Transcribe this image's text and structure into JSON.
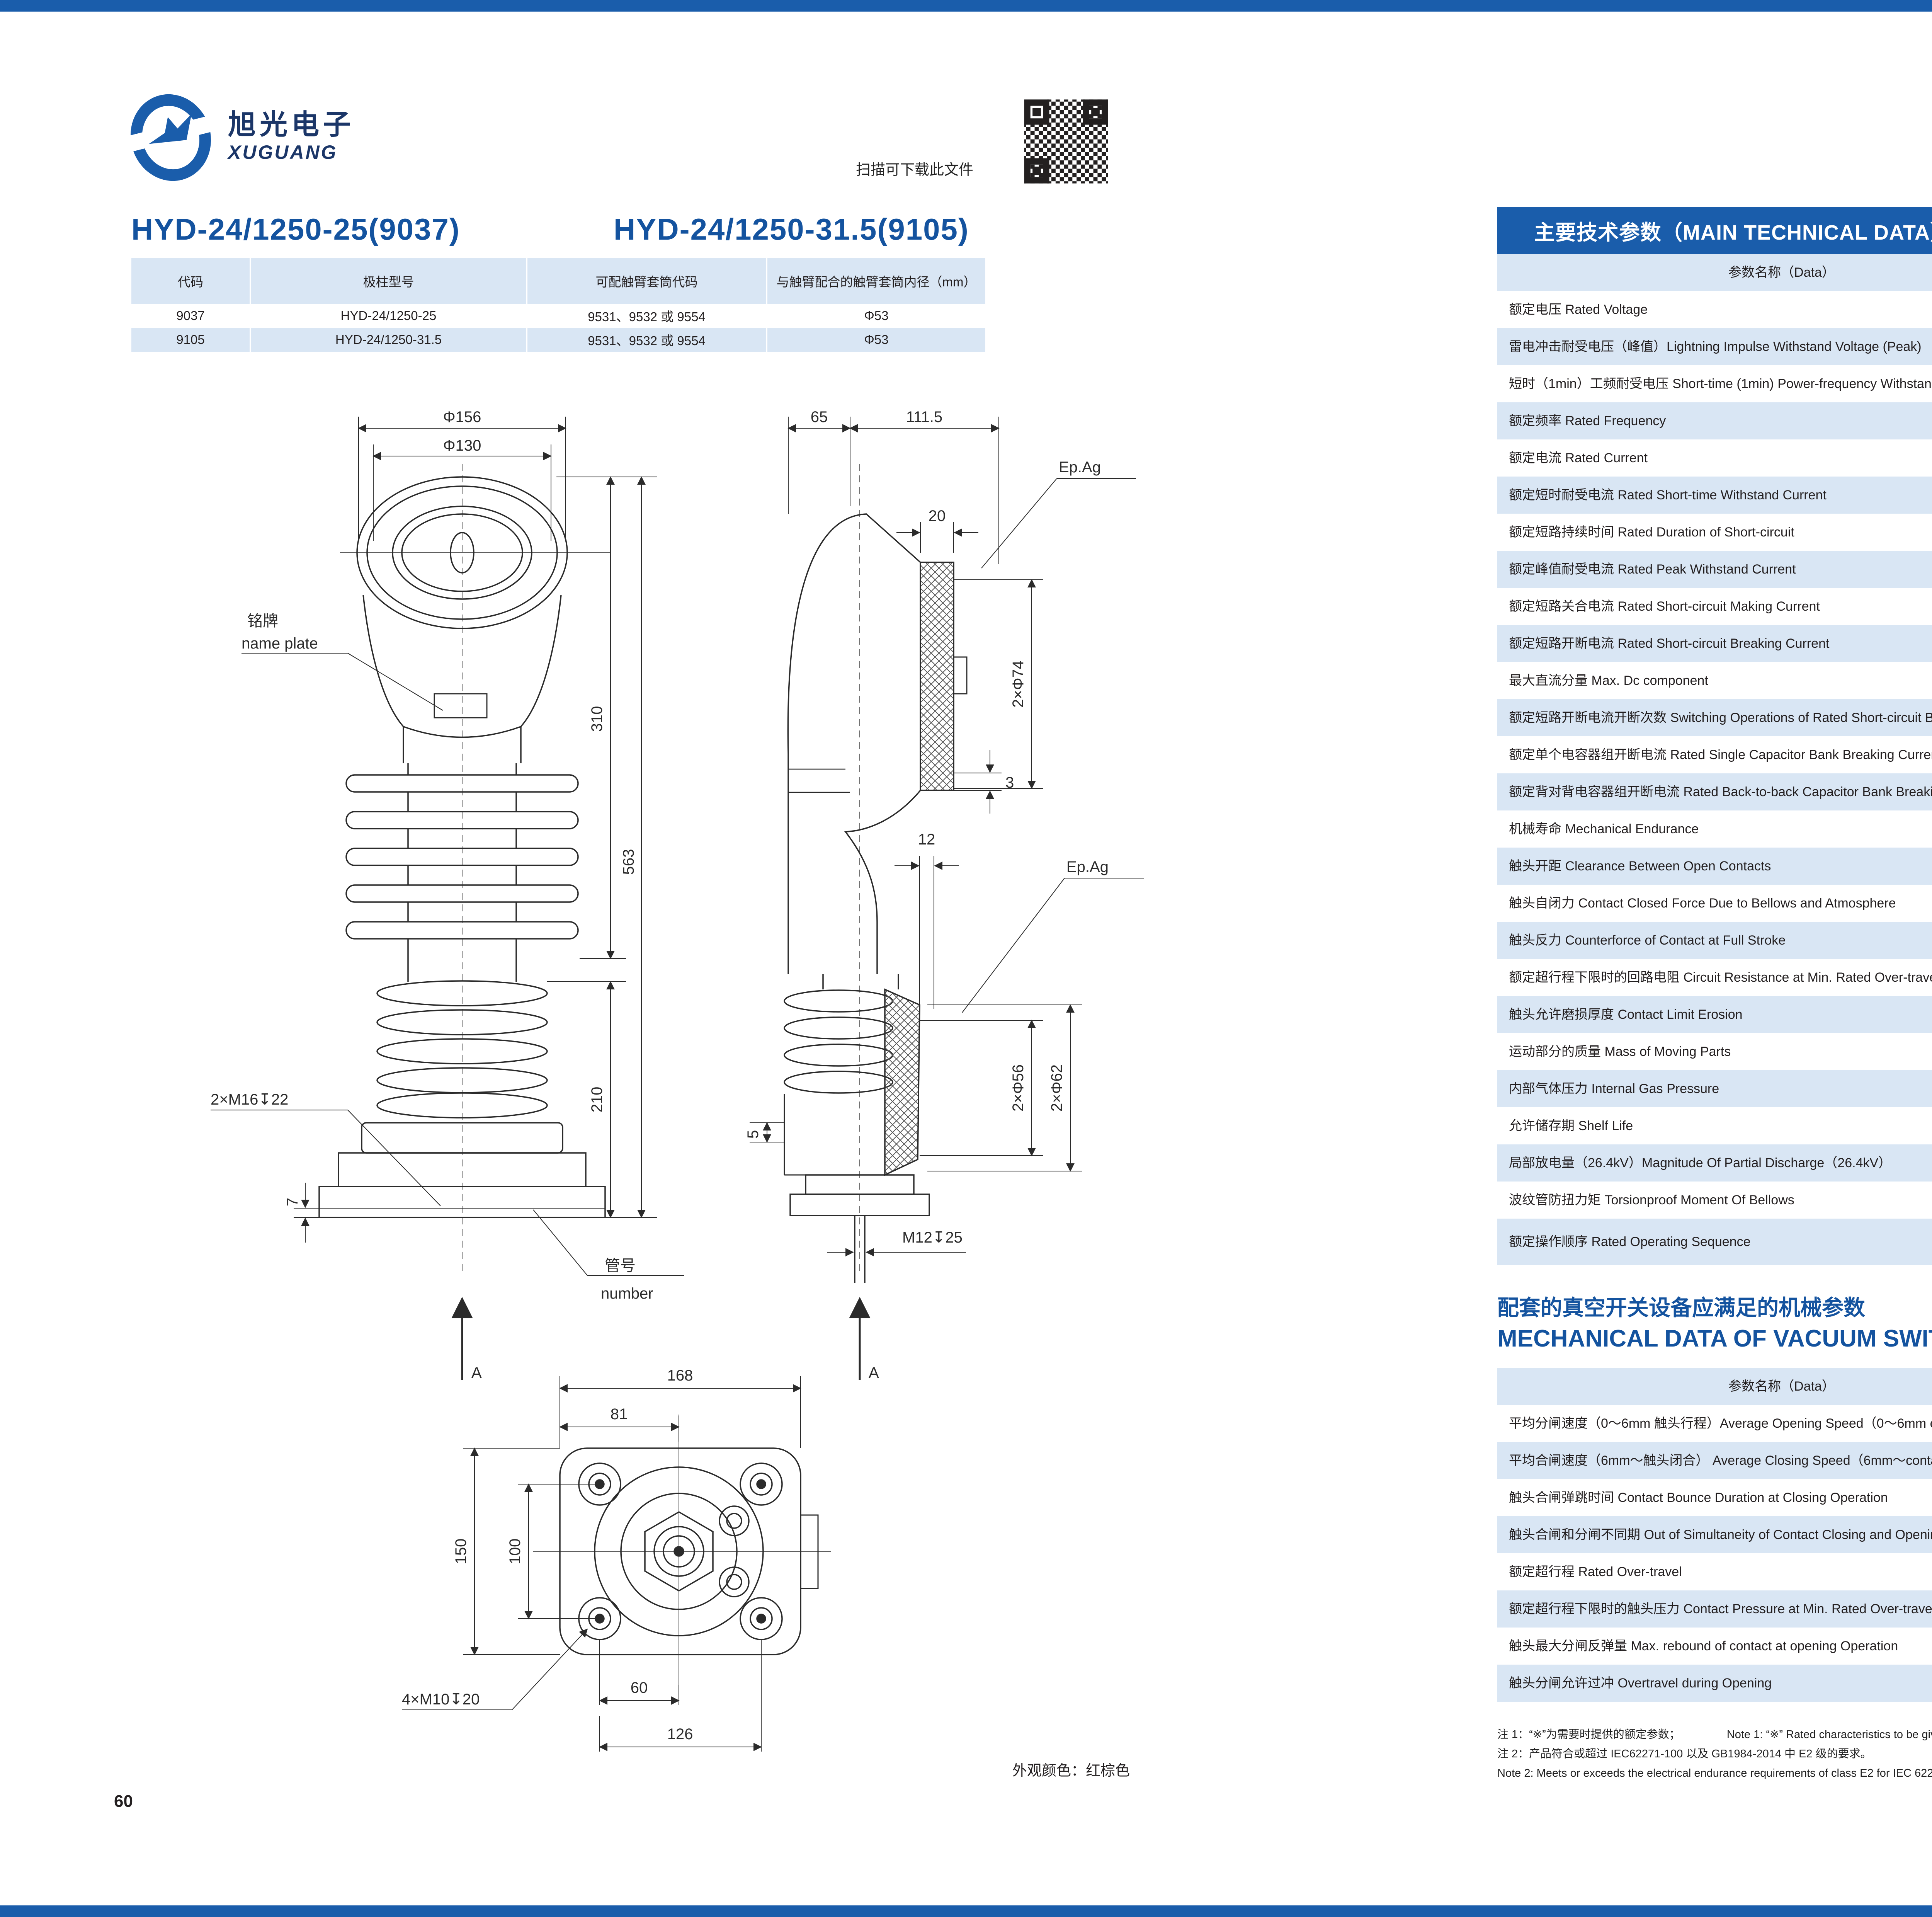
{
  "colors": {
    "accent": "#1a5dab",
    "rowblue": "#d9e6f4",
    "titleblue": "#14539f",
    "ink": "#231f20",
    "navy": "#1b3668"
  },
  "page_left": {
    "logo": {
      "cn": "旭光电子",
      "en": "XUGUANG"
    },
    "qr_caption": "扫描可下载此文件",
    "title_left": "HYD-24/1250-25(9037)",
    "title_right": "HYD-24/1250-31.5(9105)",
    "spec_table": {
      "headers": [
        "代码",
        "极柱型号",
        "可配触臂套筒代码",
        "与触臂配合的触臂套筒内径（mm）"
      ],
      "rows": [
        [
          "9037",
          "HYD-24/1250-25",
          "9531、9532 或 9554",
          "Φ53"
        ],
        [
          "9105",
          "HYD-24/1250-31.5",
          "9531、9532 或 9554",
          "Φ53"
        ]
      ]
    },
    "drawing": {
      "front": {
        "phi156": "Φ156",
        "phi130": "Φ130",
        "nameplate_cn": "铭牌",
        "nameplate_en": "name plate",
        "thread": "2×M16↧22",
        "dim310": "310",
        "dim563": "563",
        "dim210": "210",
        "dim7": "7",
        "tube_cn": "管号",
        "tube_en": "number",
        "view": "A"
      },
      "side": {
        "dim65": "65",
        "dim111": "111.5",
        "dim20": "20",
        "epag_top": "Ep.Ag",
        "phi74": "2×Φ74",
        "dim3": "3",
        "dim12": "12",
        "epag_mid": "Ep.Ag",
        "phi56": "2×Φ56",
        "phi62": "2×Φ62",
        "dim5": "5",
        "thread": "M12↧25",
        "view": "A"
      },
      "bottom": {
        "dim168": "168",
        "dim81": "81",
        "dim150": "150",
        "dim100": "100",
        "dim60": "60",
        "dim126": "126",
        "thread": "4×M10↧20"
      }
    },
    "color_note": "外观颜色：红棕色",
    "page_number": "60"
  },
  "page_right": {
    "logo": {
      "cn": "旭光电子",
      "en": "XUGUANG"
    },
    "banner": "主要技术参数（MAIN TECHNICAL DATA）",
    "main_table": {
      "headers": [
        "参数名称（Data）",
        "单位 (Unit)",
        "数值（Value）"
      ],
      "rows": [
        {
          "label": "额定电压 Rated Voltage",
          "unit": "kV",
          "value": "24"
        },
        {
          "label": "雷电冲击耐受电压（峰值）Lightning Impulse Withstand Voltage (Peak)",
          "unit": "kV",
          "value": "125"
        },
        {
          "label": "短时（1min）工频耐受电压 Short-time (1min) Power-frequency Withstand Voltage",
          "unit": "kV",
          "value": "65"
        },
        {
          "label": "额定频率 Rated Frequency",
          "unit": "Hz",
          "value": "50/60"
        },
        {
          "label": "额定电流 Rated Current",
          "unit": "A",
          "value": "1250"
        },
        {
          "label": "额定短时耐受电流 Rated Short-time Withstand Current",
          "unit": "kA",
          "value_a": "25",
          "value_b": "31.5"
        },
        {
          "label": "额定短路持续时间 Rated Duration of Short-circuit",
          "unit": "s",
          "value": "4"
        },
        {
          "label": "额定峰值耐受电流 Rated Peak Withstand Current",
          "unit": "kA",
          "value_a": "63",
          "value_b": "80"
        },
        {
          "label": "额定短路关合电流 Rated Short-circuit Making Current",
          "unit": "kA",
          "value_a": "63",
          "value_b": "80"
        },
        {
          "label": "额定短路开断电流 Rated Short-circuit Breaking Current",
          "unit": "kA",
          "value_a": "25",
          "value_b": "31.5"
        },
        {
          "label": "最大直流分量 Max. Dc component",
          "unit": "",
          "value": "40%"
        },
        {
          "label": "额定短路开断电流开断次数 Switching Operations of Rated Short-circuit Breaking Current",
          "unit": "次 Operations",
          "value": "30"
        },
        {
          "label": "额定单个电容器组开断电流 Rated Single Capacitor Bank Breaking Current",
          "unit": "A",
          "value": "630※"
        },
        {
          "label": "额定背对背电容器组开断电流 Rated Back-to-back Capacitor Bank Breaking Current",
          "unit": "A",
          "value": "400※"
        },
        {
          "label": "机械寿命 Mechanical Endurance",
          "unit": "次 Operations",
          "value": "10000"
        },
        {
          "label": "触头开距 Clearance Between Open Contacts",
          "unit": "mm",
          "value": "13±1"
        },
        {
          "label": "触头自闭力 Contact Closed Force Due to Bellows and Atmosphere",
          "unit": "N",
          "value": "110±40"
        },
        {
          "label": "触头反力 Counterforce of Contact at Full Stroke",
          "unit": "N",
          "value": "200±40"
        },
        {
          "label": "额定超行程下限时的回路电阻 Circuit Resistance at Min. Rated Over-travel",
          "unit": "μ Ω",
          "value": "≤ 25"
        },
        {
          "label": "触头允许磨损厚度 Contact Limit Erosion",
          "unit": "mm",
          "value": "3"
        },
        {
          "label": "运动部分的质量 Mass of Moving Parts",
          "unit": "kg",
          "value": "3.6±0.3"
        },
        {
          "label": "内部气体压力 Internal Gas Pressure",
          "unit": "Pa",
          "value": "<1.33×10",
          "value_sup": "-3"
        },
        {
          "label": "允许储存期 Shelf Life",
          "unit": "年 Year",
          "value": "20"
        },
        {
          "label": "局部放电量（26.4kV）Magnitude Of Partial Discharge（26.4kV）",
          "unit": "pC",
          "value": "≤ 5"
        },
        {
          "label": "波纹管防扭力矩 Torsionproof Moment Of Bellows",
          "unit": "N·m",
          "value": "≤ 45"
        },
        {
          "label": "额定操作顺序 Rated Operating Sequence",
          "unit": "",
          "value_line1": "分-0.3秒-合分-180秒-合分",
          "value_line2": "O - 0.3s - CO - 180s - CO"
        }
      ]
    },
    "mech_title_cn": "配套的真空开关设备应满足的机械参数",
    "mech_title_en": "MECHANICAL DATA OF VACUUM SWITCH EQUIPPED WITH THE INTERRUPTERS",
    "mech_table": {
      "headers": [
        "参数名称（Data）",
        "单位（Unit）",
        "数值（Value）"
      ],
      "rows": [
        {
          "label": "平均分闸速度（0～6mm 触头行程）Average Opening Speed（0～6mm contact travel）",
          "unit": "m/s",
          "value": "1.4±0.2"
        },
        {
          "label": "平均合闸速度（6mm～触头闭合） Average Closing Speed（6mm～contact close position）",
          "unit": "m/s",
          "value": "0.8±0.2"
        },
        {
          "label": "触头合闸弹跳时间 Contact Bounce Duration at Closing Operation",
          "unit": "ms",
          "value": "≤ 2"
        },
        {
          "label": "触头合闸和分闸不同期 Out of Simultaneity of Contact Closing and Opening",
          "unit": "ms",
          "value": "≤ 2"
        },
        {
          "label": "额定超行程 Rated Over-travel",
          "unit": "mm",
          "value": "4±1"
        },
        {
          "label": "额定超行程下限时的触头压力 Contact Pressure at Min. Rated Over-travel",
          "unit": "N",
          "value_a": "2500",
          "value_a_sup": "+600",
          "value_a_sub": "-300",
          "value_b": "3200±300"
        },
        {
          "label": "触头最大分闸反弹量 Max. rebound of contact at opening Operation",
          "unit": "mm",
          "value": "2"
        },
        {
          "label": "触头分闸允许过冲 Overtravel during Opening",
          "unit": "mm",
          "value": "≤ 2"
        }
      ]
    },
    "notes": {
      "n1_cn": "注 1：“※”为需要时提供的额定参数；",
      "n1_en": "Note 1: “※” Rated characteristics to be given on request;",
      "n2_cn": "注 2：产品符合或超过 IEC62271-100 以及 GB1984-2014 中 E2 级的要求。",
      "n2_en": "Note 2: Meets or exceeds the electrical endurance requirements of class E2 for IEC 62271-100 and GB1984-2014."
    },
    "page_number": "61"
  }
}
